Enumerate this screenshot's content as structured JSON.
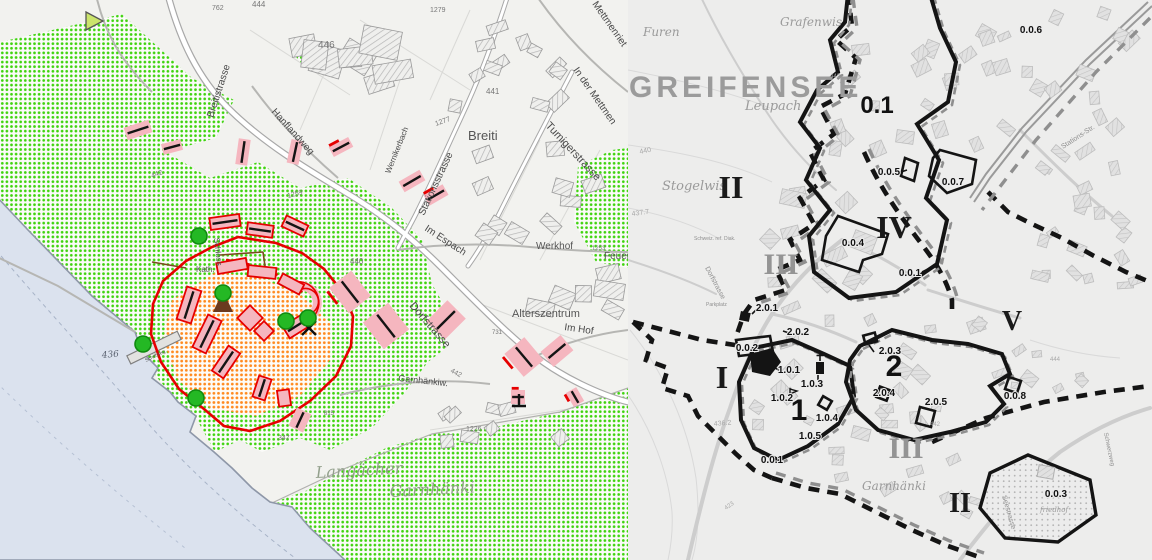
{
  "left_map": {
    "street_labels": [
      {
        "t": "Breitistrasse",
        "x": 213,
        "y": 118,
        "r": -72,
        "s": 10
      },
      {
        "t": "Hanflandweg",
        "x": 271,
        "y": 112,
        "r": 48,
        "s": 10
      },
      {
        "t": "Wernikerbach",
        "x": 390,
        "y": 174,
        "r": -68,
        "s": 8
      },
      {
        "t": "Stationsstrasse",
        "x": 424,
        "y": 216,
        "r": -65,
        "s": 10
      },
      {
        "t": "Tumigerstrasse",
        "x": 545,
        "y": 126,
        "r": 47,
        "s": 11
      },
      {
        "t": "In der Mettmen",
        "x": 573,
        "y": 70,
        "r": 55,
        "s": 10
      },
      {
        "t": "Mettmenriet",
        "x": 592,
        "y": 4,
        "r": 55,
        "s": 10
      },
      {
        "t": "Im Espach",
        "x": 424,
        "y": 230,
        "r": 33,
        "s": 10
      },
      {
        "t": "Dorfstrasse",
        "x": 409,
        "y": 306,
        "r": 49,
        "s": 11
      },
      {
        "t": "Im Hof",
        "x": 564,
        "y": 330,
        "r": 8,
        "s": 10
      },
      {
        "t": "Garnhänkiw.",
        "x": 398,
        "y": 381,
        "r": 6,
        "s": 9
      },
      {
        "t": "Schloss",
        "x": 214,
        "y": 238,
        "r": 84,
        "s": 8
      }
    ],
    "place_labels": [
      {
        "t": "Breiti",
        "x": 468,
        "y": 140,
        "s": 13,
        "c": "#777"
      },
      {
        "t": "Werkhof",
        "x": 536,
        "y": 249,
        "s": 10,
        "c": "#333"
      },
      {
        "t": "Feuerwehr",
        "x": 604,
        "y": 259,
        "s": 10,
        "c": "#333"
      },
      {
        "t": "Alterszentrum",
        "x": 512,
        "y": 317,
        "s": 11,
        "c": "#333"
      },
      {
        "t": "Kath.",
        "x": 196,
        "y": 272,
        "s": 8,
        "c": "#566"
      },
      {
        "t": "Schiffsteg",
        "x": 146,
        "y": 362,
        "r": -26,
        "s": 5,
        "c": "#555"
      }
    ],
    "field_labels": [
      {
        "t": "Langächer",
        "x": 316,
        "y": 478,
        "s": 16,
        "r": -3
      },
      {
        "t": "Garnhänki",
        "x": 390,
        "y": 497,
        "s": 16,
        "r": -3
      }
    ],
    "elevation_labels": [
      {
        "t": "436",
        "x": 102,
        "y": 358,
        "s": 9,
        "r": -5
      }
    ],
    "parcel_numbers": [
      {
        "t": "762",
        "x": 212,
        "y": 10,
        "s": 7
      },
      {
        "t": "444",
        "x": 252,
        "y": 7,
        "s": 8
      },
      {
        "t": "1279",
        "x": 430,
        "y": 12,
        "s": 7
      },
      {
        "t": "446",
        "x": 318,
        "y": 48,
        "s": 10,
        "c": "#444"
      },
      {
        "t": "441",
        "x": 486,
        "y": 94,
        "s": 8,
        "c": "#555"
      },
      {
        "t": "1277",
        "x": 436,
        "y": 126,
        "s": 7,
        "r": -20
      },
      {
        "t": "1259",
        "x": 288,
        "y": 198,
        "s": 7,
        "r": -15
      },
      {
        "t": "442",
        "x": 152,
        "y": 178,
        "s": 7,
        "r": -20
      },
      {
        "t": "440",
        "x": 350,
        "y": 264,
        "s": 8
      },
      {
        "t": "442",
        "x": 450,
        "y": 372,
        "s": 7,
        "r": 28
      },
      {
        "t": "731",
        "x": 492,
        "y": 334,
        "s": 6
      },
      {
        "t": "1226",
        "x": 466,
        "y": 431,
        "s": 7
      },
      {
        "t": "347",
        "x": 278,
        "y": 440,
        "s": 7
      },
      {
        "t": "815",
        "x": 324,
        "y": 415,
        "s": 6
      },
      {
        "t": "1253",
        "x": 592,
        "y": 250,
        "s": 6
      }
    ]
  },
  "right_map": {
    "title": "GREIFENSEE",
    "place_labels": [
      {
        "t": "Furen",
        "x": 643,
        "y": 36,
        "s": 12
      },
      {
        "t": "Grafenwis",
        "x": 780,
        "y": 26,
        "s": 12
      },
      {
        "t": "Leupach",
        "x": 745,
        "y": 110,
        "s": 13
      },
      {
        "t": "Stogelwis",
        "x": 662,
        "y": 190,
        "s": 13
      },
      {
        "t": "Garnhänki",
        "x": 862,
        "y": 490,
        "s": 12
      },
      {
        "t": "friedhof",
        "x": 1040,
        "y": 512,
        "s": 7,
        "c": "#999"
      }
    ],
    "street_labels": [
      {
        "t": "Stations-Str.",
        "x": 1063,
        "y": 149,
        "r": -33,
        "s": 7
      },
      {
        "t": "Dorfstrasse",
        "x": 705,
        "y": 268,
        "r": 62,
        "s": 7
      },
      {
        "t": "Seestrasse",
        "x": 1002,
        "y": 496,
        "r": 74,
        "s": 7
      },
      {
        "t": "Schwerzweg",
        "x": 1104,
        "y": 433,
        "r": 78,
        "s": 6
      },
      {
        "t": "Parkplatz",
        "x": 706,
        "y": 306,
        "s": 5
      },
      {
        "t": "Schweiz. ref. Diak.",
        "x": 694,
        "y": 240,
        "s": 5
      }
    ],
    "contour_labels": [
      {
        "t": "440",
        "x": 640,
        "y": 154,
        "r": -12,
        "s": 7
      },
      {
        "t": "437.7",
        "x": 632,
        "y": 216,
        "r": -8,
        "s": 7
      },
      {
        "t": "436.2",
        "x": 714,
        "y": 426,
        "r": -5,
        "s": 7
      },
      {
        "t": "423",
        "x": 726,
        "y": 510,
        "r": -35,
        "s": 6
      },
      {
        "t": "442",
        "x": 830,
        "y": 78,
        "s": 6
      },
      {
        "t": "444",
        "x": 1050,
        "y": 361,
        "s": 6
      },
      {
        "t": "442",
        "x": 930,
        "y": 426,
        "s": 6
      }
    ],
    "district_numerals": [
      {
        "t": "II",
        "x": 731,
        "y": 198,
        "s": 32,
        "c": "#1a1a1a"
      },
      {
        "t": "III",
        "x": 781,
        "y": 274,
        "s": 30,
        "c": "#949494"
      },
      {
        "t": "IV",
        "x": 894,
        "y": 238,
        "s": 32,
        "c": "#1a1a1a"
      },
      {
        "t": "V",
        "x": 1012,
        "y": 330,
        "s": 28,
        "c": "#1a1a1a"
      },
      {
        "t": "I",
        "x": 722,
        "y": 388,
        "s": 32,
        "c": "#1a1a1a"
      },
      {
        "t": "III",
        "x": 906,
        "y": 458,
        "s": 30,
        "c": "#949494"
      },
      {
        "t": "II",
        "x": 960,
        "y": 512,
        "s": 28,
        "c": "#1a1a1a"
      }
    ],
    "zone_numbers": [
      {
        "t": "0.1",
        "x": 877,
        "y": 113,
        "s": 24
      },
      {
        "t": "1",
        "x": 799,
        "y": 420,
        "s": 30
      },
      {
        "t": "2",
        "x": 894,
        "y": 376,
        "s": 30
      }
    ],
    "subzone_labels": [
      {
        "t": "0.0.6",
        "x": 1031,
        "y": 33,
        "s": 10
      },
      {
        "t": "0.0.5",
        "x": 889,
        "y": 175,
        "s": 10
      },
      {
        "t": "0.0.7",
        "x": 953,
        "y": 185,
        "s": 10
      },
      {
        "t": "0.0.4",
        "x": 853,
        "y": 246,
        "s": 10
      },
      {
        "t": "0.0.1",
        "x": 910,
        "y": 276,
        "s": 10
      },
      {
        "t": "2.0.1",
        "x": 767,
        "y": 311,
        "s": 10
      },
      {
        "t": "2.0.2",
        "x": 798,
        "y": 335,
        "s": 10
      },
      {
        "t": "0.0.2",
        "x": 747,
        "y": 351,
        "s": 10
      },
      {
        "t": "2.0.3",
        "x": 890,
        "y": 354,
        "s": 10
      },
      {
        "t": "1.0.1",
        "x": 789,
        "y": 373,
        "s": 10
      },
      {
        "t": "1.0.3",
        "x": 812,
        "y": 387,
        "s": 10
      },
      {
        "t": "1.0.2",
        "x": 782,
        "y": 401,
        "s": 10
      },
      {
        "t": "2.0.4",
        "x": 884,
        "y": 396,
        "s": 10
      },
      {
        "t": "2.0.5",
        "x": 936,
        "y": 405,
        "s": 10
      },
      {
        "t": "0.0.8",
        "x": 1015,
        "y": 399,
        "s": 10
      },
      {
        "t": "1.0.4",
        "x": 827,
        "y": 421,
        "s": 10
      },
      {
        "t": "1.0.5",
        "x": 810,
        "y": 439,
        "s": 10
      },
      {
        "t": "0.0.1",
        "x": 772,
        "y": 463,
        "s": 10
      },
      {
        "t": "0.0.3",
        "x": 1056,
        "y": 497,
        "s": 10
      }
    ]
  },
  "colors": {
    "green_dots": "#3fd30e",
    "orange_dots": "#ff8a1e",
    "core_boundary": "#e60000",
    "building_pink": "#f5b6bf",
    "lake": "#dbe2ee",
    "tree_green": "#24b824",
    "title_gray": "#9b9b9b",
    "boundary_black": "#141414"
  }
}
